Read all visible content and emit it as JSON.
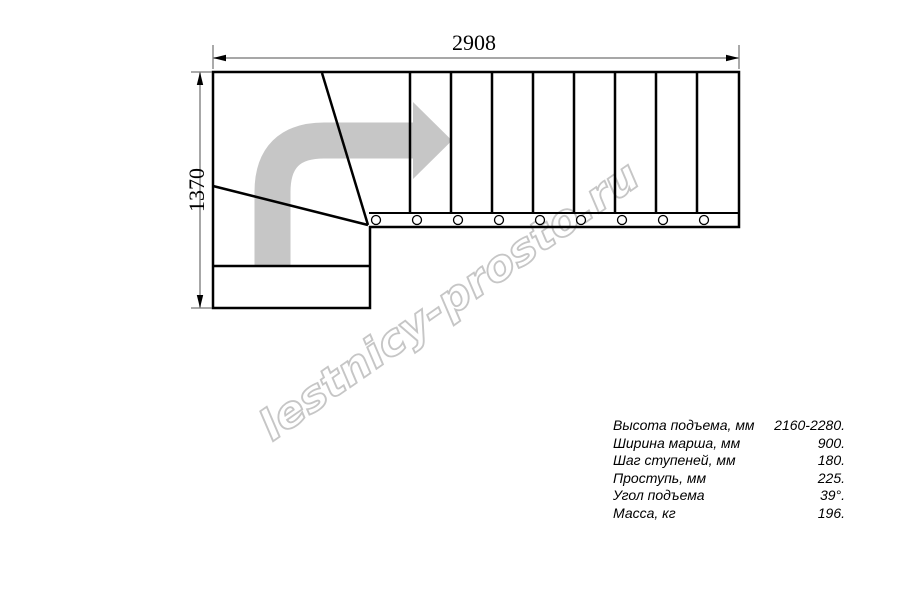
{
  "diagram": {
    "title": "staircase-plan-top-view",
    "width_dim_label": "2908",
    "height_dim_label": "1370",
    "watermark": "lestnicy-prosto.ru",
    "straight_steps": 9,
    "winder_steps": 2,
    "turn_direction": "right"
  },
  "colors": {
    "outline": "#000000",
    "arrow": "#c6c6c6",
    "watermark": "#c4c4c4",
    "dimension_line": "#8a8a8a"
  },
  "specs": [
    {
      "label": "Высота подъема, мм",
      "value": "2160-2280."
    },
    {
      "label": "Ширина марша, мм",
      "value": "900."
    },
    {
      "label": "Шаг ступеней, мм",
      "value": "180."
    },
    {
      "label": "Проступь, мм",
      "value": "225."
    },
    {
      "label": "Угол подъема",
      "value": "39°."
    },
    {
      "label": "Масса, кг",
      "value": "196."
    }
  ]
}
